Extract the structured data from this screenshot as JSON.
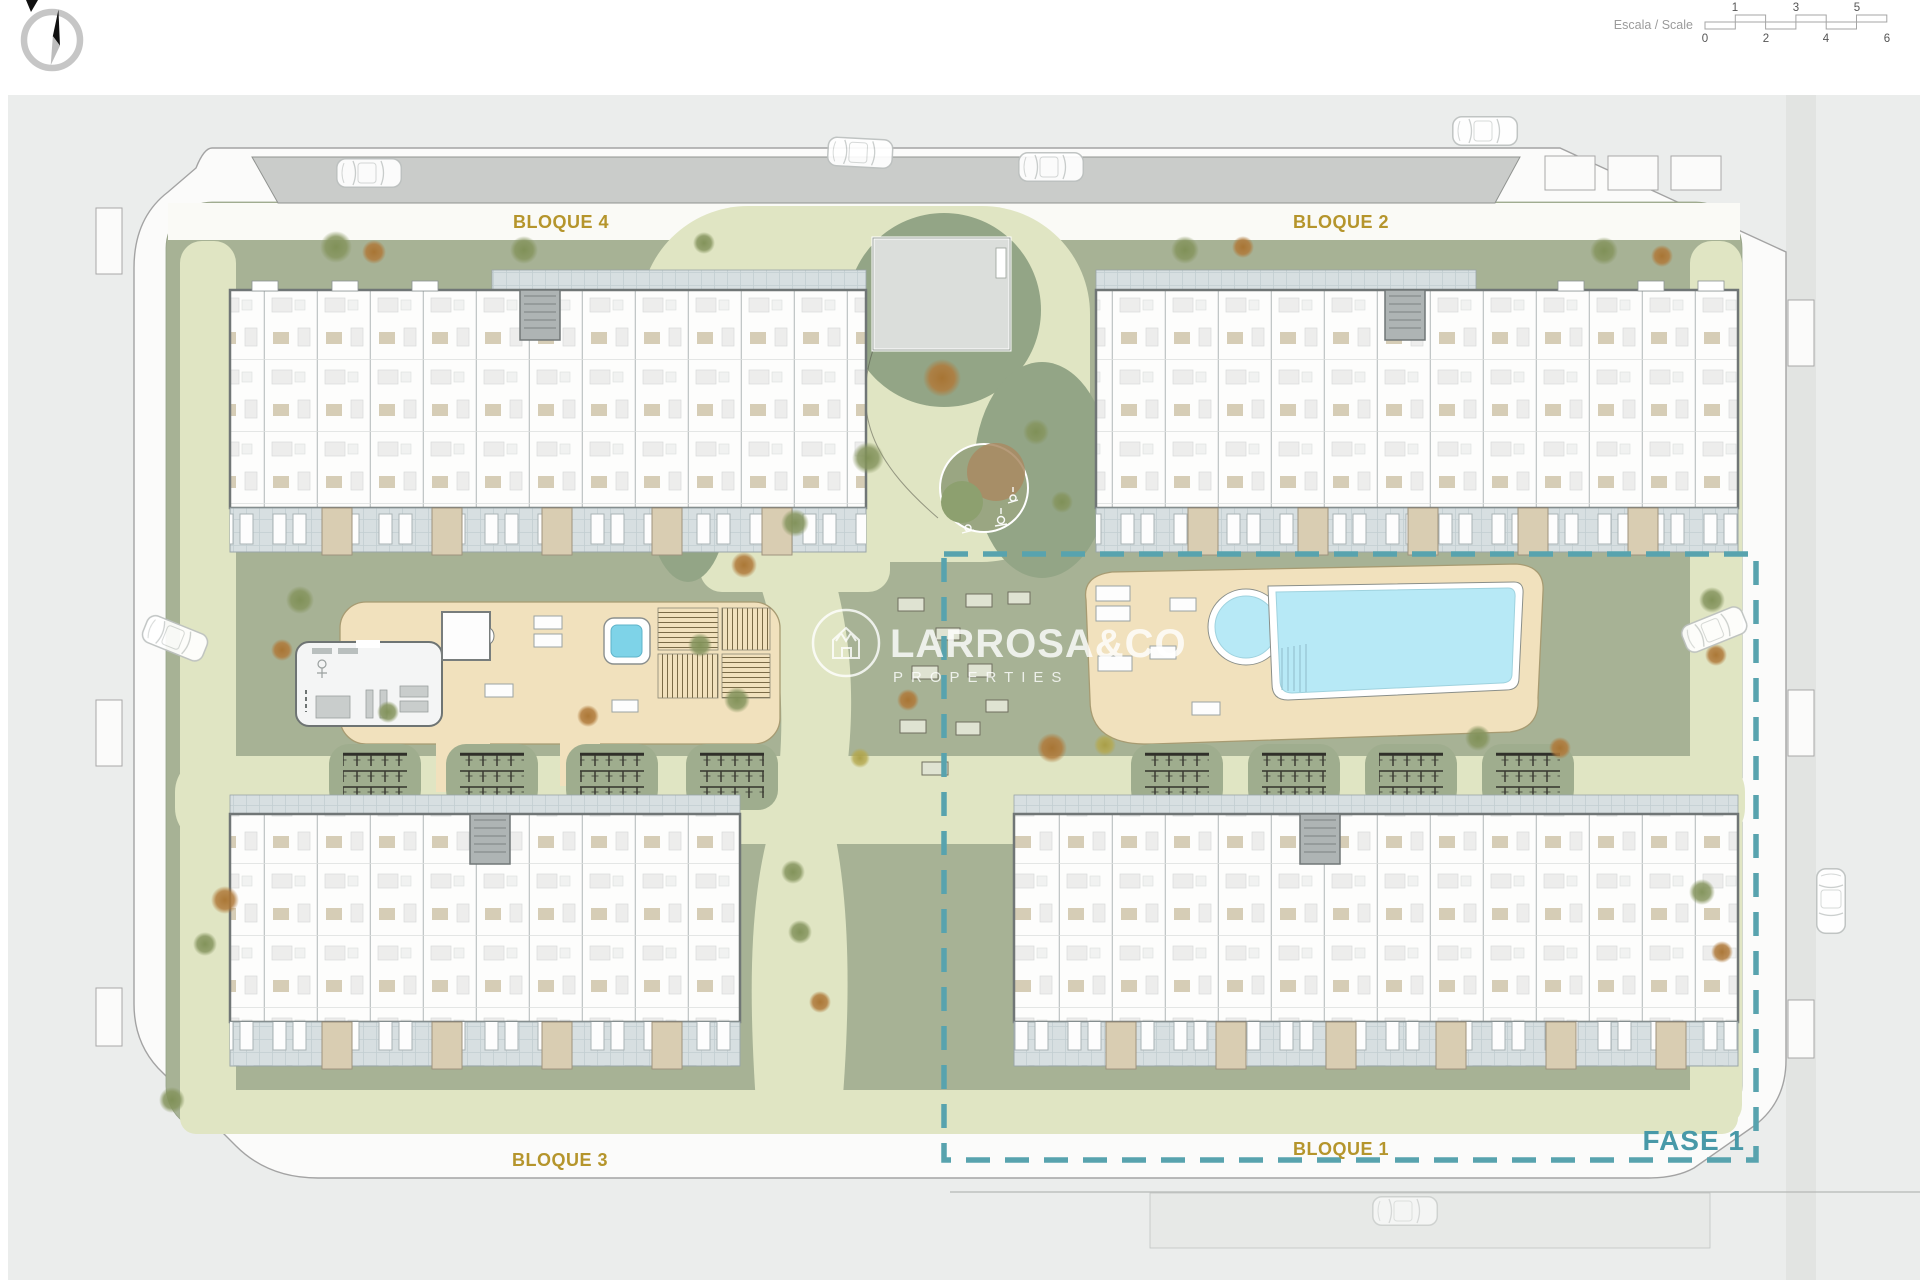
{
  "plan": {
    "labels": {
      "bloque4": "BLOQUE 4",
      "bloque2": "BLOQUE 2",
      "bloque3": "BLOQUE 3",
      "bloque1": "BLOQUE 1",
      "fase": "FASE 1"
    },
    "watermark": {
      "brand": "LARROSA&CO",
      "subtitle": "PROPERTIES"
    },
    "scale": {
      "label": "Escala / Scale",
      "top": [
        "1",
        "3",
        "5"
      ],
      "bottom": [
        "0",
        "2",
        "4",
        "6"
      ]
    },
    "colors": {
      "phase_accent": "#58a3ae",
      "block_label_gold": "#b5952c",
      "pool_water": "#b7e9f6",
      "spa_water": "#7ed3e8",
      "deck_sand": "#f1e1bd",
      "site_green": "#a7b295",
      "dark_green": "#93a586",
      "path_light": "#e0e5c3",
      "terrace_tile": "#d7dfe1",
      "parking_gray": "#caccca",
      "background_gray": "#ebedec"
    }
  }
}
